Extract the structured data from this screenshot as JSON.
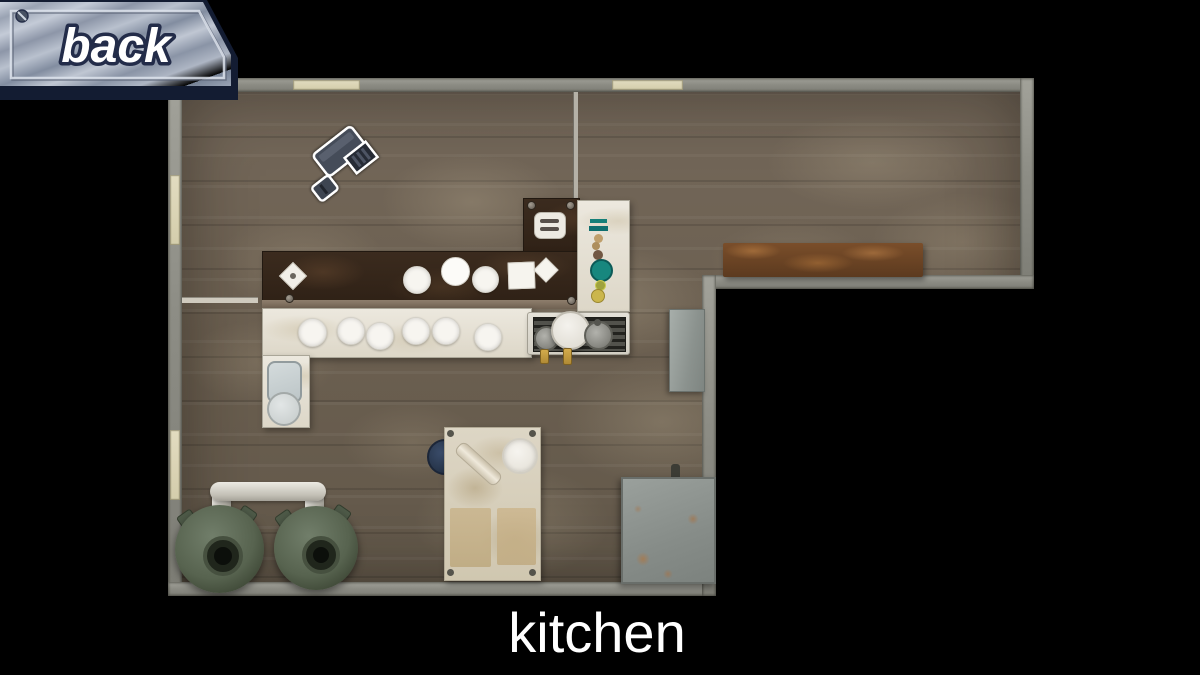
{
  "screen": {
    "background_color": "#000000",
    "room_label": "kitchen"
  },
  "back_button": {
    "label": "back",
    "style": "metallic-plate",
    "metal_color": "#a8b1bf",
    "border_color": "#141d33",
    "text_color": "#ffffff"
  },
  "map": {
    "room_name": "kitchen",
    "shape": "L-shaped",
    "wall_color": "#8d8d85",
    "floor_color": "#6b5f50",
    "door_color": "#d8d2b2",
    "door_openings": {
      "top_wall": 2,
      "left_wall": 2
    },
    "camera": {
      "icon": "security-camera-icon",
      "location": "upper-left floor"
    },
    "furniture": [
      {
        "name": "dark-prep-counter",
        "color": "#35271a",
        "items": [
          "small-diamond-plate",
          "round-plate",
          "round-plate",
          "round-plate",
          "square-plate",
          "small-diamond-plate",
          "toaster"
        ]
      },
      {
        "name": "white-serving-counter",
        "color": "#e8e4da",
        "items": [
          "plate",
          "plate",
          "plate",
          "plate",
          "plate",
          "plate"
        ]
      },
      {
        "name": "condiment-column",
        "items": [
          "teal-jar-lid",
          "teal-jar-lid",
          "spice-dot",
          "spice-dot",
          "spice-dot",
          "teal-jar",
          "olive-jar",
          "mustard-jar"
        ]
      },
      {
        "name": "sink-unit",
        "items": [
          "basin",
          "round-pot"
        ]
      },
      {
        "name": "stove",
        "items": [
          "white-pot",
          "gray-pan",
          "gray-pot",
          "gas-knob",
          "gas-knob"
        ]
      },
      {
        "name": "wall-shelf",
        "color": "#6a4325"
      },
      {
        "name": "refrigerator-block",
        "color": "#99a09c"
      },
      {
        "name": "work-table",
        "items": [
          "rolling-pin",
          "mixing-bowl",
          "blue-pot",
          "baking-tray",
          "baking-tray"
        ]
      },
      {
        "name": "metal-crate",
        "color": "#8e938f"
      },
      {
        "name": "kettle-left",
        "color": "#57634f"
      },
      {
        "name": "kettle-right",
        "color": "#57634f"
      },
      {
        "name": "gas-pipe",
        "color": "#d6d3cb"
      }
    ]
  }
}
